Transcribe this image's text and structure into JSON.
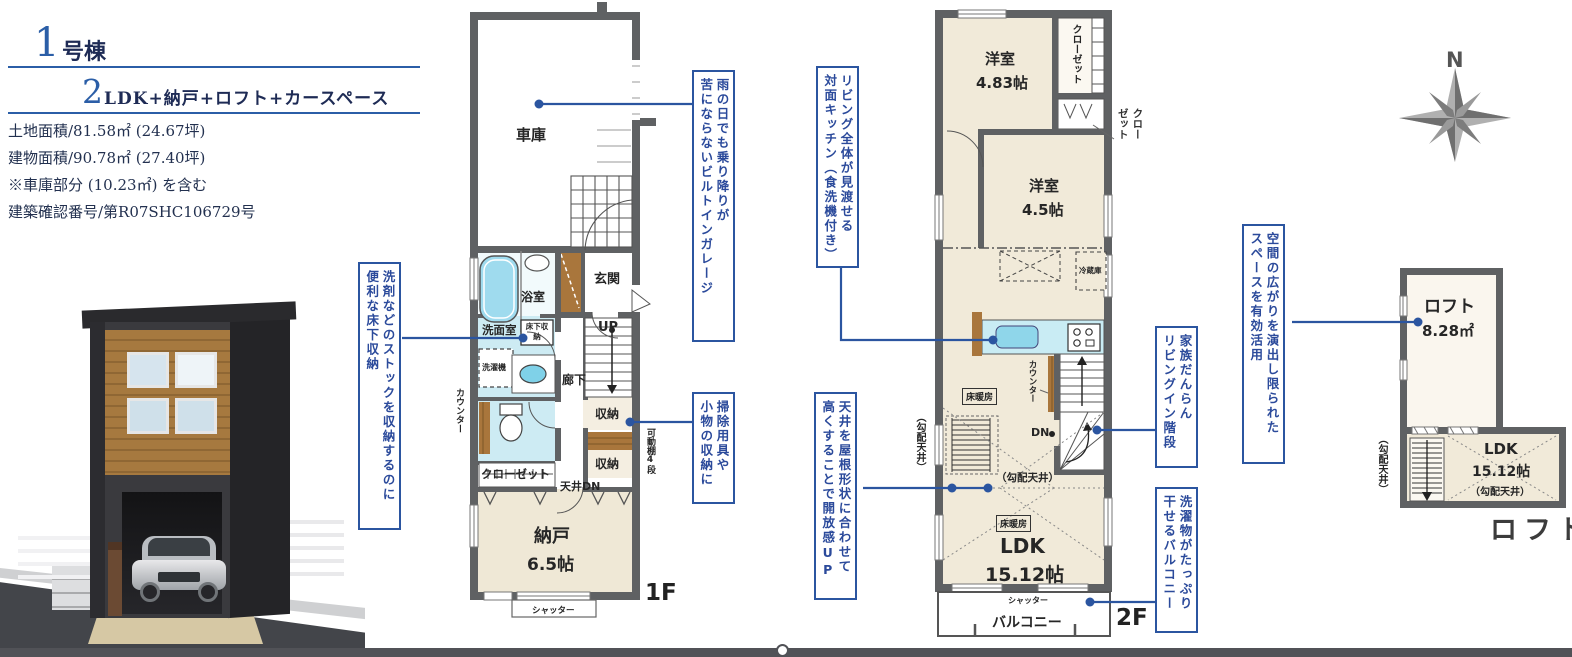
{
  "header": {
    "unit_number": "1",
    "unit_suffix": "号棟",
    "plan_number": "2",
    "plan_text": "LDK+納戸+ロフト+カースペース",
    "spec_lines": [
      "土地面積/81.58㎡ (24.67坪)",
      "建物面積/90.78㎡ (27.40坪)",
      "※車庫部分 (10.23㎡) を含む",
      "建築確認番号/第R07SHC106729号"
    ]
  },
  "compass": {
    "north": "N"
  },
  "colors": {
    "accent_blue": "#2b55a0",
    "navy_text": "#22304f",
    "wall_gray": "#5f6163",
    "floor_cream": "#efe8d6",
    "wet_blue": "#cdebf3",
    "wood_brown": "#a9763c"
  },
  "floor1": {
    "floor_label": "1F",
    "garage": "車庫",
    "bathroom": "浴室",
    "entrance": "玄関",
    "washroom": "洗面室",
    "underfloor_storage": "床下収納",
    "washer": "洗濯機",
    "hallway": "廊下",
    "stairs_up": "UP",
    "storage_a": "収納",
    "storage_b": "収納",
    "movable_shelf": "可動棚4段",
    "counter": "カウンター",
    "closet": "クローゼット",
    "ceiling_down": "天井DN",
    "storeroom_name": "納戸",
    "storeroom_size": "6.5帖",
    "shutter": "シャッター"
  },
  "floor2": {
    "floor_label": "2F",
    "bedroom1_name": "洋室",
    "bedroom1_size": "4.83帖",
    "closet1": "クローゼット",
    "closet2_line1": "クロー",
    "closet2_line2": "ゼット",
    "bedroom2_name": "洋室",
    "bedroom2_size": "4.5帖",
    "fridge": "冷蔵庫",
    "counter": "カウンター",
    "stairs_down": "DN",
    "floor_heating_a": "床暖房",
    "floor_heating_b": "床暖房",
    "sloped_ceiling_in": "（勾配天井）",
    "sloped_ceiling_out": "（勾配天井）",
    "ldk_name": "LDK",
    "ldk_size": "15.12帖",
    "shutter": "シャッター",
    "balcony": "バルコニー"
  },
  "loft": {
    "floor_label": "ロフト",
    "loft_name": "ロフト",
    "loft_size": "8.28㎡",
    "ldk_name": "LDK",
    "ldk_size": "15.12帖",
    "sloped_ceiling_in": "（勾配天井）",
    "sloped_ceiling_out": "（勾配天井）"
  },
  "callouts": {
    "underfloor": {
      "line1": "洗剤などのストックを収納するのに",
      "line2": "便利な床下収納"
    },
    "garage": {
      "line1": "雨の日でも乗り降りが",
      "line2": "苦にならないビルトインガレージ"
    },
    "cleaning": {
      "line1": "掃除用具や",
      "line2": "小物の収納に"
    },
    "kitchen": {
      "line1": "リビング全体が見渡せる",
      "line2": "対面キッチン（食洗機付き）"
    },
    "ceiling": {
      "line1": "天井を屋根形状に合わせて",
      "line2": "高くすることで開放感UP"
    },
    "stairs": {
      "line1": "家族だんらん",
      "line2": "リビングイン階段"
    },
    "balcony": {
      "line1": "洗濯物がたっぷり",
      "line2": "干せるバルコニー"
    },
    "loft": {
      "line1": "空間の広がりを演出し限られた",
      "line2": "スペースを有効活用"
    }
  }
}
